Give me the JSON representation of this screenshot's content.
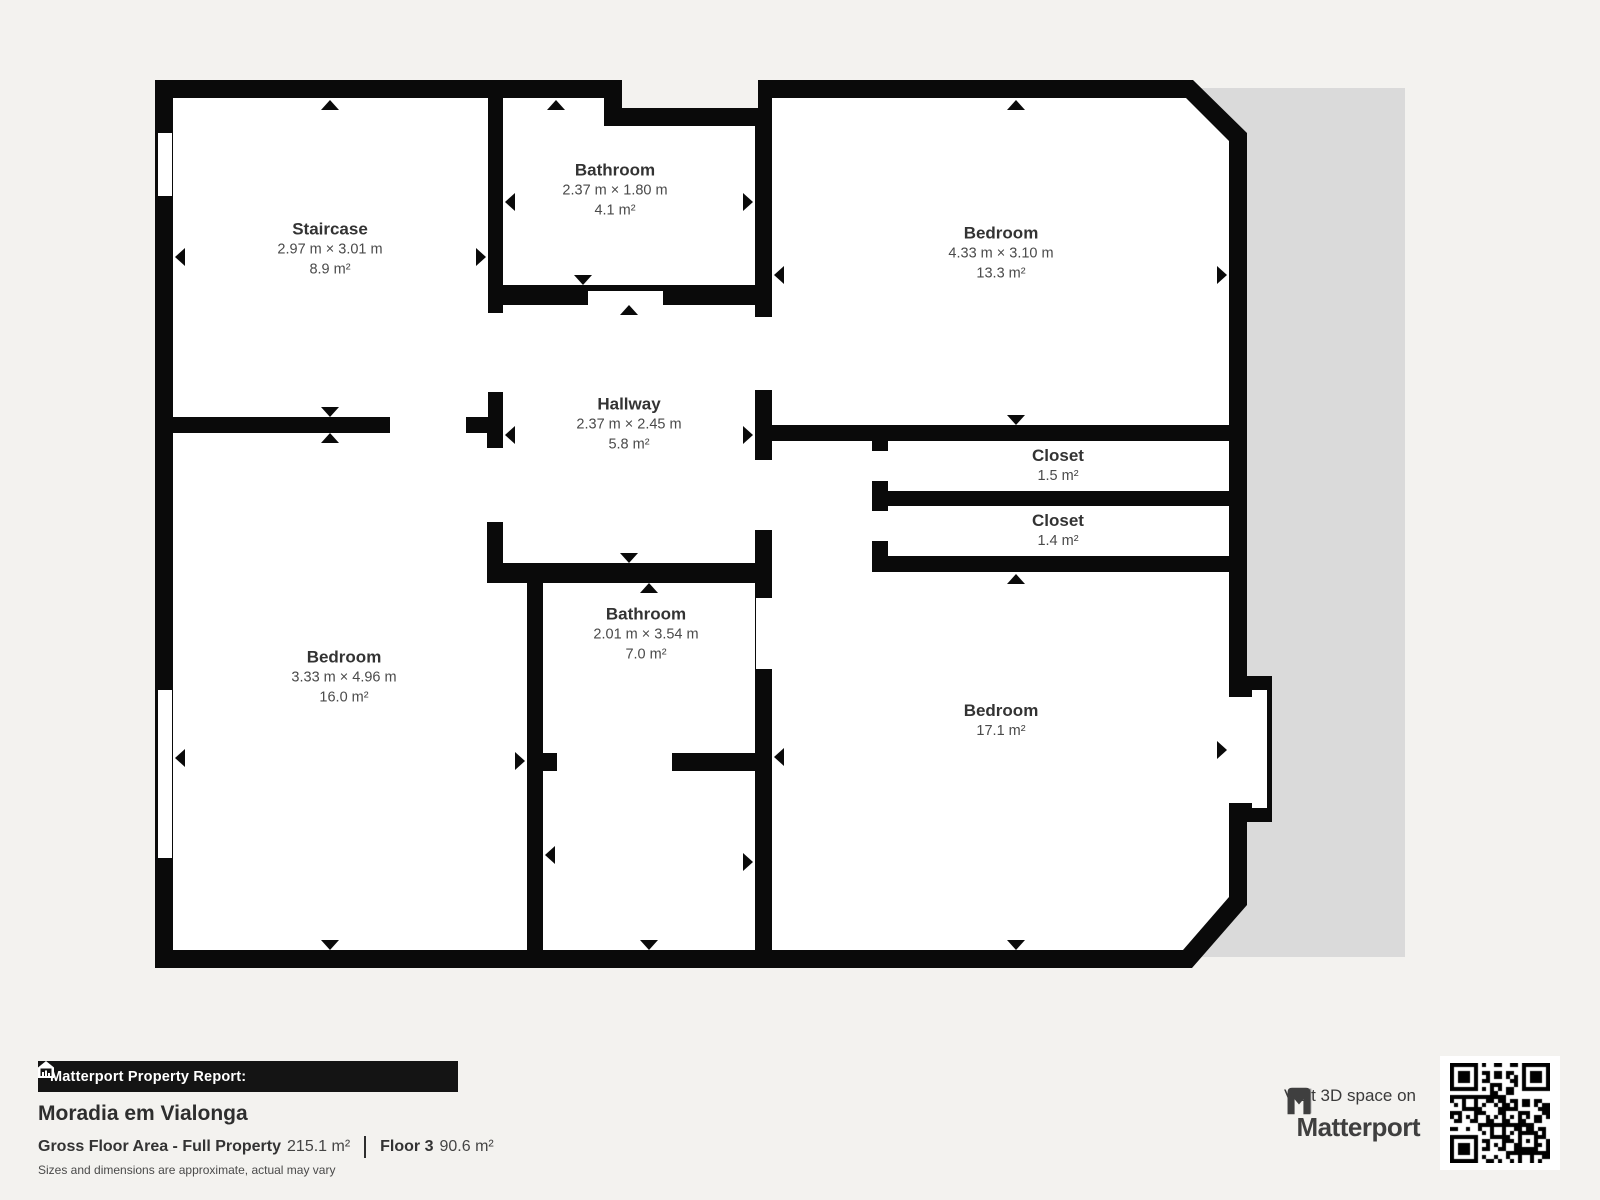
{
  "floorplan": {
    "rooms": [
      {
        "id": "staircase",
        "name": "Staircase",
        "dims": "2.97 m × 3.01 m",
        "area": "8.9 m²"
      },
      {
        "id": "bathroom-top",
        "name": "Bathroom",
        "dims": "2.37 m × 1.80 m",
        "area": "4.1 m²"
      },
      {
        "id": "bedroom-top-right",
        "name": "Bedroom",
        "dims": "4.33 m × 3.10 m",
        "area": "13.3 m²"
      },
      {
        "id": "hallway",
        "name": "Hallway",
        "dims": "2.37 m × 2.45 m",
        "area": "5.8 m²"
      },
      {
        "id": "closet-1",
        "name": "Closet",
        "area": "1.5 m²"
      },
      {
        "id": "closet-2",
        "name": "Closet",
        "area": "1.4 m²"
      },
      {
        "id": "bathroom-mid",
        "name": "Bathroom",
        "dims": "2.01 m × 3.54 m",
        "area": "7.0 m²"
      },
      {
        "id": "bedroom-left",
        "name": "Bedroom",
        "dims": "3.33 m × 4.96 m",
        "area": "16.0 m²"
      },
      {
        "id": "bedroom-bottom-right",
        "name": "Bedroom",
        "area": "17.1 m²"
      }
    ]
  },
  "footer": {
    "report_label": "Matterport Property Report:",
    "property_name": "Moradia em Vialonga",
    "gfa_label": "Gross Floor Area - Full Property",
    "gfa_value": "215.1 m²",
    "floor_label": "Floor 3",
    "floor_value": "90.6 m²",
    "disclaimer": "Sizes and dimensions are approximate, actual may vary",
    "visit_label": "Visit 3D space on",
    "brand": "Matterport"
  },
  "colors": {
    "wall": "#0a0a0a",
    "room": "#ffffff",
    "background": "#f3f2ef",
    "shadow": "#dadada",
    "bar": "#141414"
  }
}
